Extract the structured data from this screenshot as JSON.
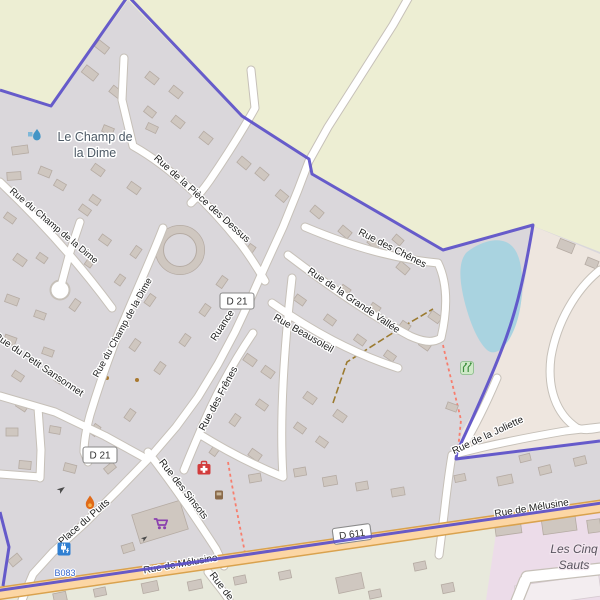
{
  "map": {
    "streets": [
      {
        "label": "Rue de la Pièce des Dessus"
      },
      {
        "label": "Rue des Chênes"
      },
      {
        "label": "Rue de la Grande Vallée"
      },
      {
        "label": "Rue Beausoleil"
      },
      {
        "label": "Rue des Frênes"
      },
      {
        "label": "Rue du Champ de la Dime"
      },
      {
        "label": "Rue du Champ de la Dime"
      },
      {
        "label": "Rue du Petit Sansonnet"
      },
      {
        "label": "Ruance"
      },
      {
        "label": "Rue des Sinsots"
      },
      {
        "label": "Place du Puits"
      },
      {
        "label": "Rue de la Joliette"
      },
      {
        "label": "Rue de Mélusine"
      },
      {
        "label": "Rue de Mélusine"
      },
      {
        "label": "Rue de"
      }
    ],
    "places": {
      "hamlet": {
        "line1": "Le Champ de",
        "line2": "la Dime"
      },
      "retail_area": {
        "line1": "Les Cinq",
        "line2": "Sauts"
      }
    },
    "road_refs": {
      "d21": "D 21",
      "d611": "D 611"
    },
    "poi": {
      "charging_station_ref": "B083"
    },
    "colors": {
      "farmland": "#edeed3",
      "residential": "#dad7db",
      "land_east": "#eee6df",
      "green_zone": "#e8e9dc",
      "retail": "#ecdce9",
      "water": "#a9d3e0",
      "building": "#cfc7c0",
      "building_line": "#b5aba3",
      "road_fill": "#ffffff",
      "road_casing": "#c6c0b8",
      "primary_fill": "#fcd6a4",
      "primary_casing": "#d9a24e",
      "boundary": "#5b4fc9",
      "path": "#f77e6e",
      "track": "#9b7a2f",
      "place_label": "#4d5a66",
      "area_label": "#5a5560",
      "charging": "#2f7fd2",
      "charging_text": "#3566cc",
      "supermarket": "#8a3fae",
      "first_aid": "#d23c3c",
      "flame": "#e06a18",
      "playground_bg": "#cfe9c8",
      "playground_fg": "#3e8e3e"
    }
  }
}
